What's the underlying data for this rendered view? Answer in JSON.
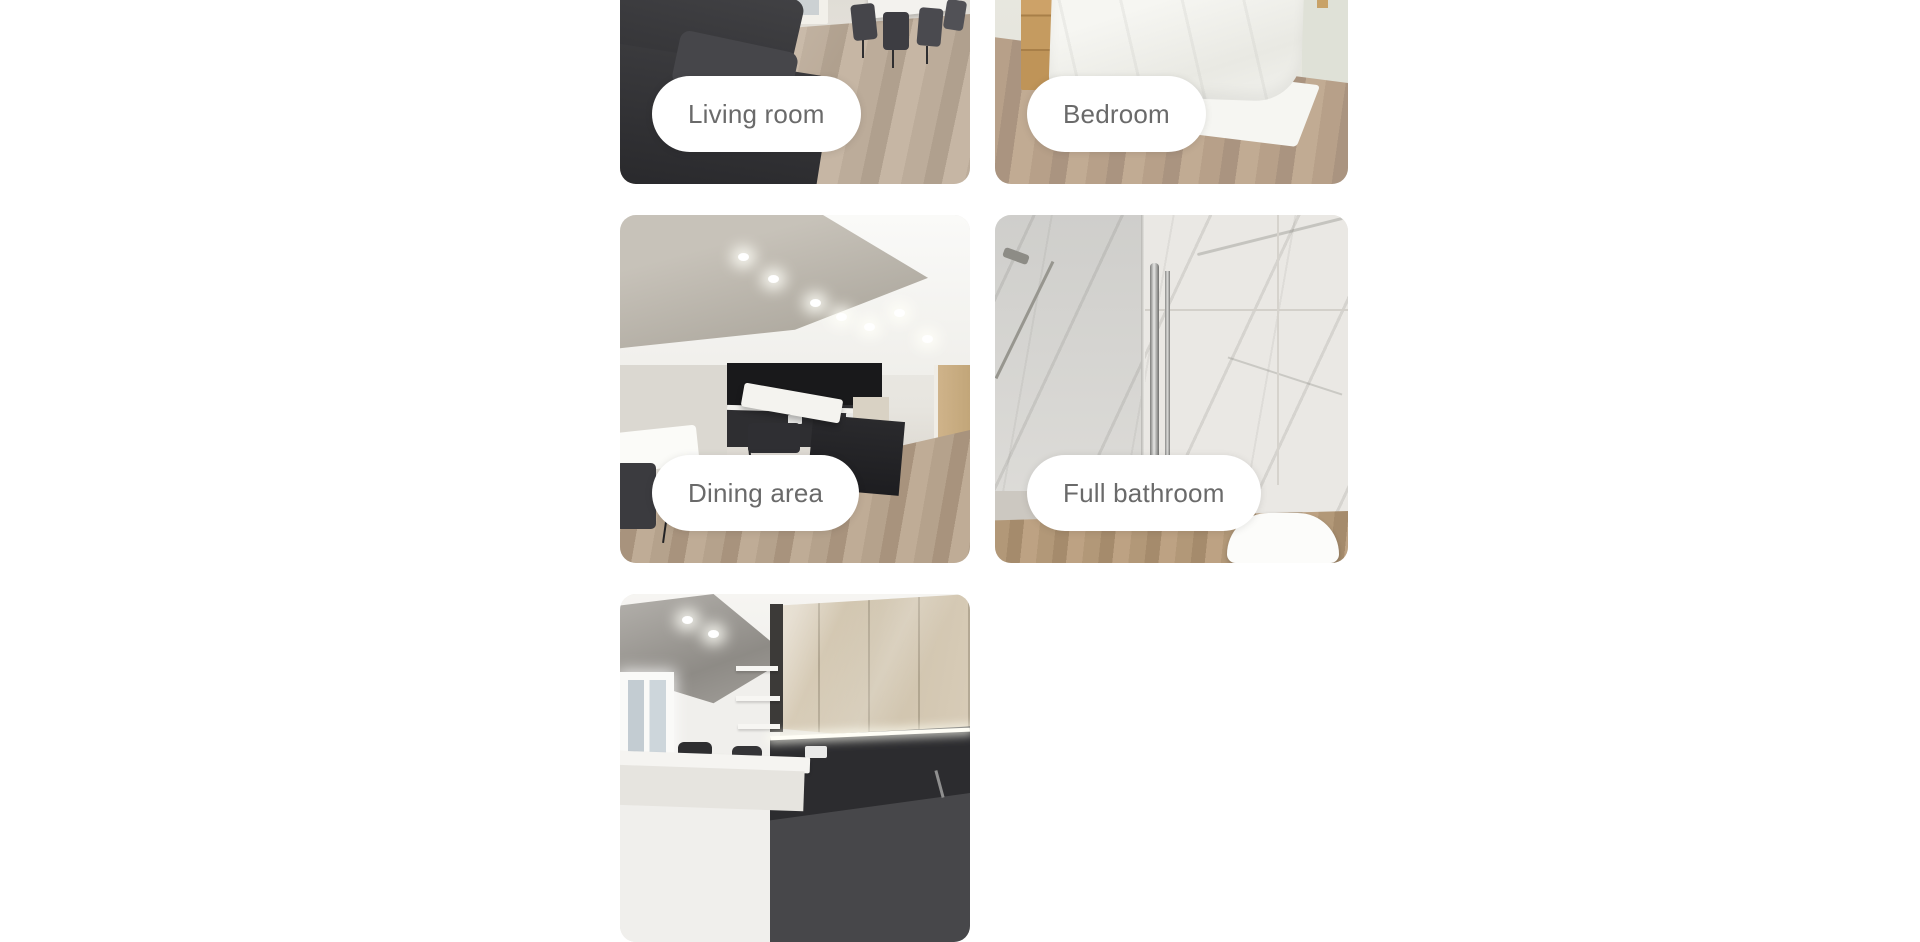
{
  "page": {
    "background_color": "#ffffff"
  },
  "gallery": {
    "photos": [
      {
        "name": "living-room",
        "label": "Living room"
      },
      {
        "name": "bedroom",
        "label": "Bedroom"
      },
      {
        "name": "dining-area",
        "label": "Dining area"
      },
      {
        "name": "full-bathroom",
        "label": "Full bathroom"
      },
      {
        "name": "kitchen"
      }
    ],
    "pill_style": {
      "background": "#ffffff",
      "text_color": "#6a6a6a"
    }
  }
}
